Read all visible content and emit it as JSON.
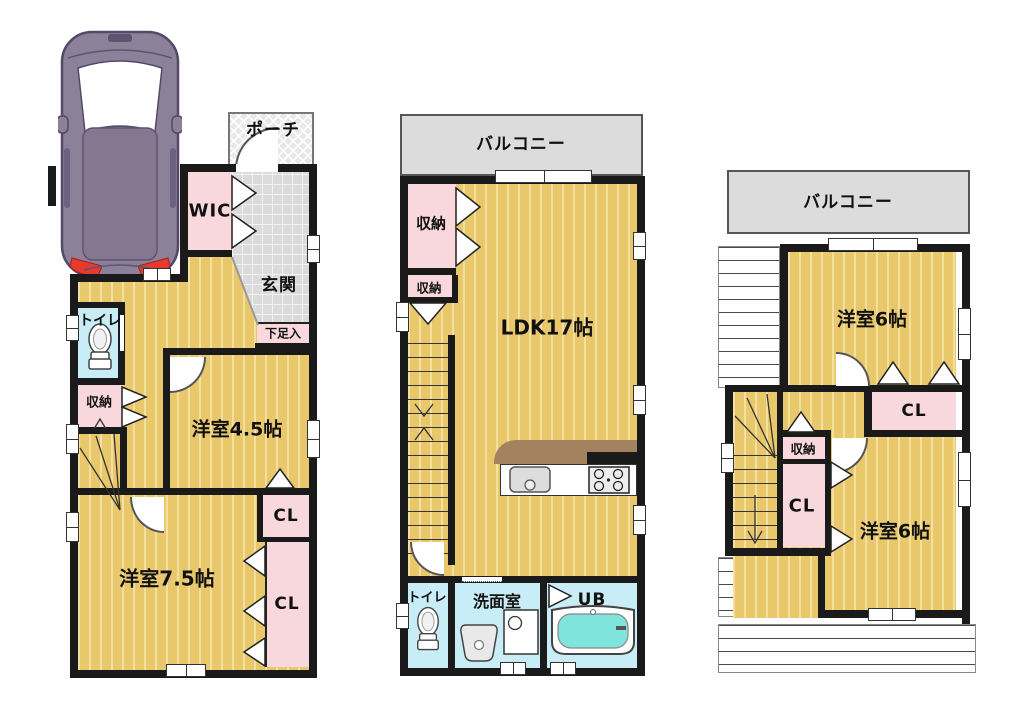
{
  "palette": {
    "wall": "#1a1a1a",
    "floor_yellow": "#e9c76b",
    "floor_stripe": "#f3dfa0",
    "closet_pink": "#f9d8dd",
    "wet_room_cyan": "#c9edf6",
    "balcony_gray": "#dcdcdc",
    "counter_brown": "#a3825f",
    "bath_water": "#7fe4dc",
    "car_body": "#8d8099",
    "tail_light_red": "#e8392f"
  },
  "floor1": {
    "porch": "ポーチ",
    "wic": "WIC",
    "entrance": "玄関",
    "shoe_cabinet": "下足入",
    "toilet": "トイレ",
    "storage": "収納",
    "room_45": "洋室4.5帖",
    "closet_a": "CL",
    "room_75": "洋室7.5帖",
    "closet_b": "CL"
  },
  "floor2": {
    "balcony": "バルコニー",
    "storage_a": "収納",
    "storage_b": "収納",
    "ldk": "LDK17帖",
    "toilet": "トイレ",
    "washroom": "洗面室",
    "bath": "UB"
  },
  "floor3": {
    "balcony": "バルコニー",
    "room_a": "洋室6帖",
    "closet_a": "CL",
    "storage": "収納",
    "closet_b": "CL",
    "room_b": "洋室6帖"
  }
}
